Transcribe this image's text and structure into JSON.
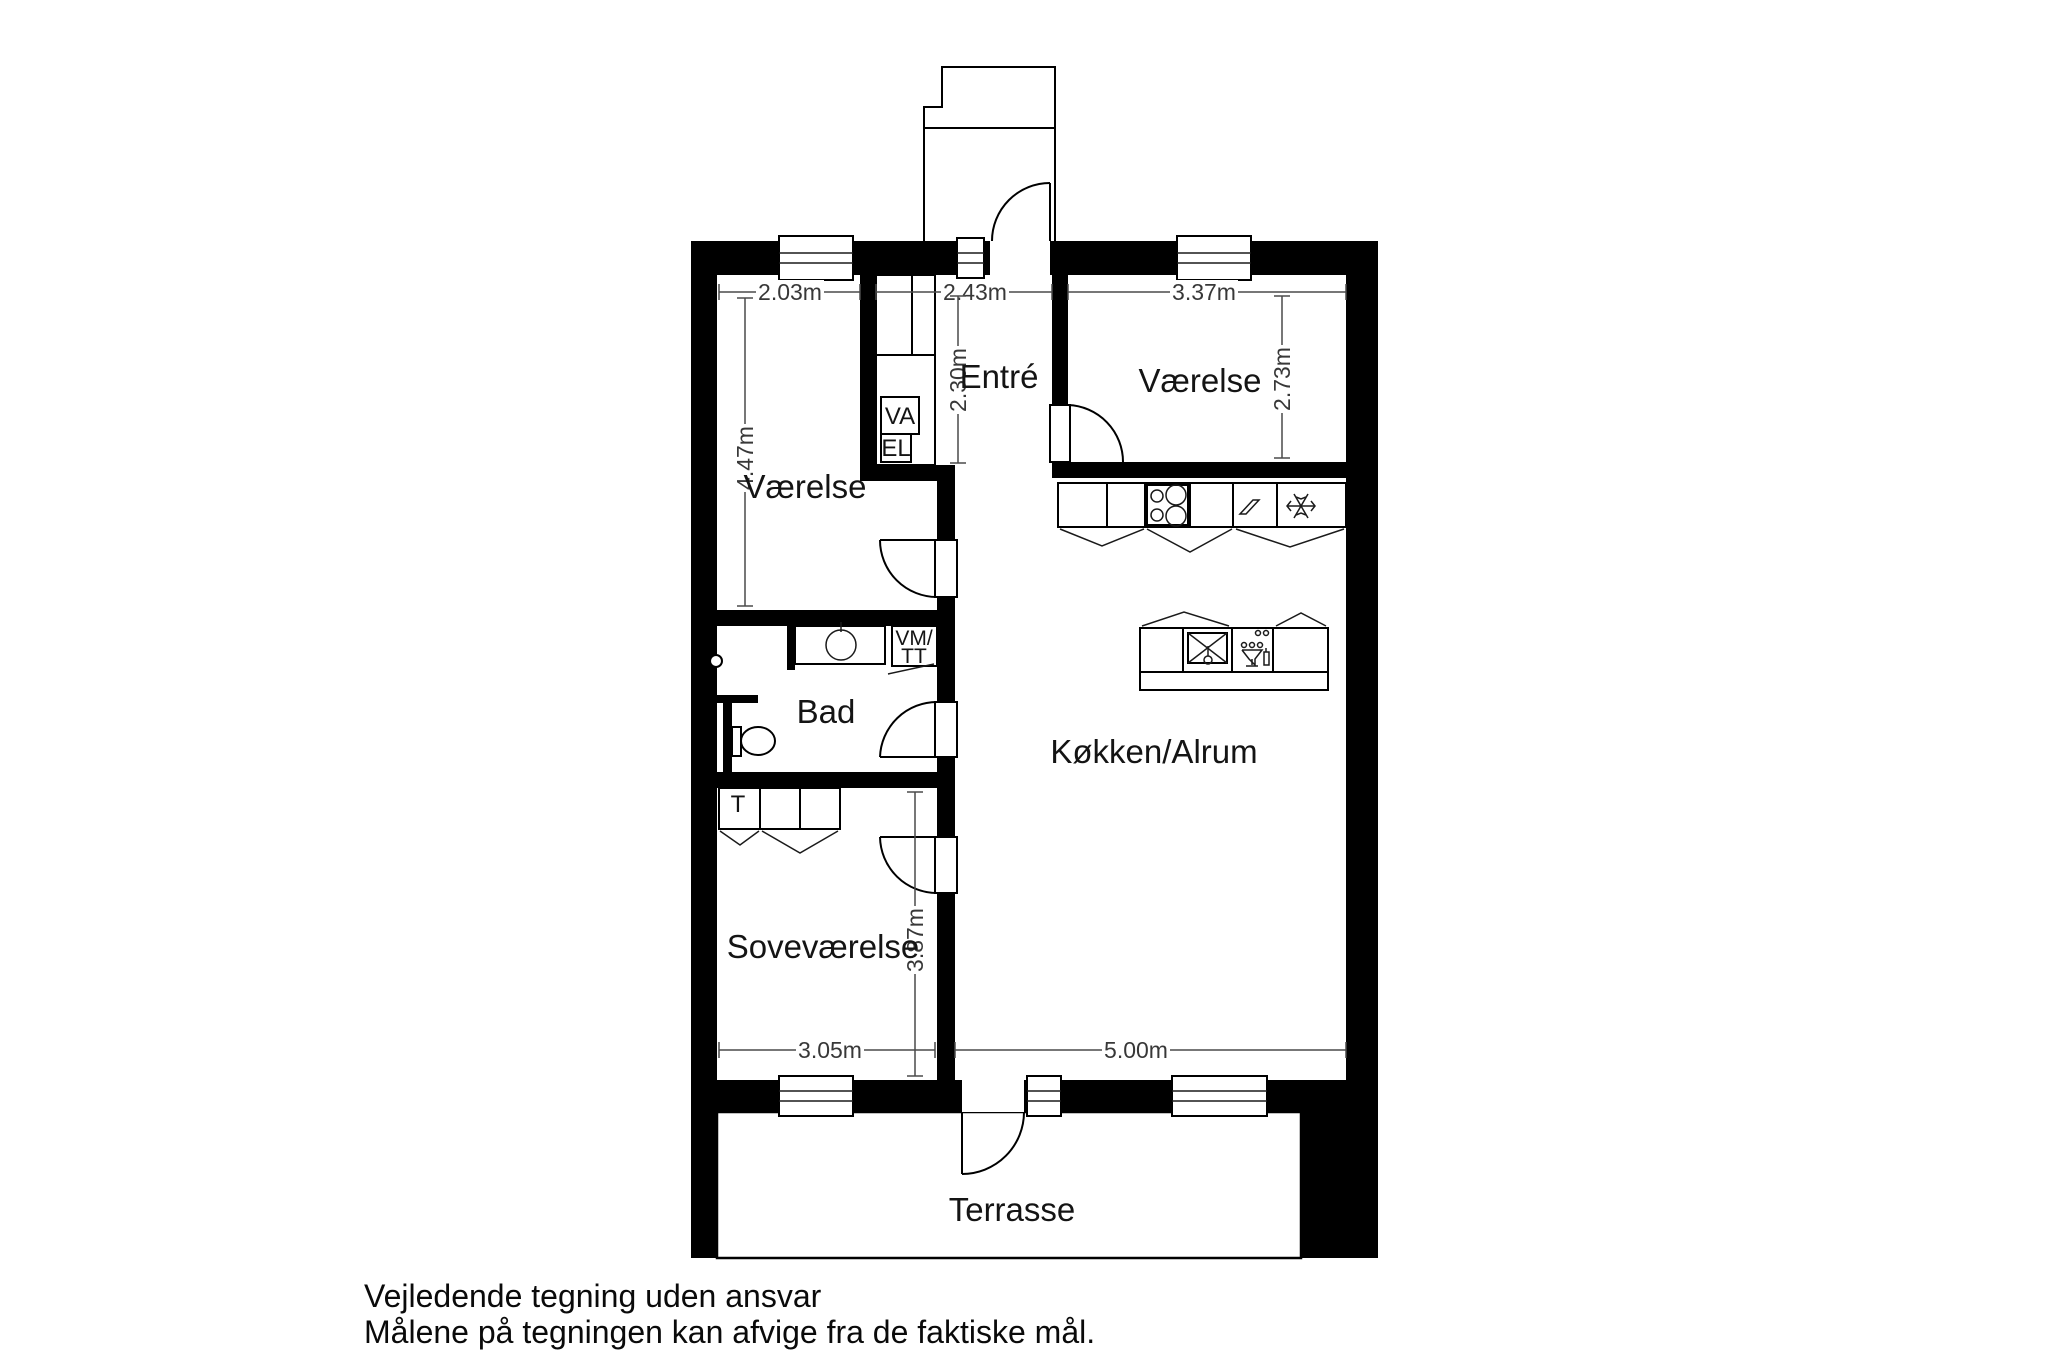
{
  "document": {
    "type": "floor-plan",
    "footer": {
      "line1": "Vejledende tegning uden ansvar",
      "line2": "Målene på tegningen kan afvige fra de faktiske mål."
    }
  },
  "rooms": {
    "vaerelse_left": {
      "label": "Værelse"
    },
    "vaerelse_right": {
      "label": "Værelse"
    },
    "entre": {
      "label": "Entré"
    },
    "bad": {
      "label": "Bad"
    },
    "sovevaerelse": {
      "label": "Soveværelse"
    },
    "kokken_alrum": {
      "label": "Køkken/Alrum"
    },
    "terrasse": {
      "label": "Terrasse"
    }
  },
  "closets": {
    "va": {
      "label": "VA"
    },
    "el": {
      "label": "EL"
    },
    "vm_tt": {
      "line1": "VM/",
      "line2": "TT"
    },
    "t": {
      "label": "T"
    }
  },
  "dimensions": {
    "vaerelse_left_width": {
      "label": "2.03m"
    },
    "entre_width": {
      "label": "2.43m"
    },
    "vaerelse_right_width": {
      "label": "3.37m"
    },
    "vaerelse_left_depth": {
      "label": "4.47m"
    },
    "entre_depth": {
      "label": "2.30m"
    },
    "vaerelse_right_depth": {
      "label": "2.73m"
    },
    "sovevaerelse_depth": {
      "label": "3.87m"
    },
    "sovevaerelse_width": {
      "label": "3.05m"
    },
    "kokken_width": {
      "label": "5.00m"
    }
  },
  "icons": {
    "stove": "four-burner-circles",
    "freezer": "snowflake",
    "appliance_power": "zigzag",
    "island_sink": "crossed-square-with-tap",
    "dishwasher": "wine-glass-with-dots",
    "toilet": "toilet-bowl",
    "washbasin": "circle-basin",
    "shower": "shower-head-circle"
  },
  "colors": {
    "wall": "#000000",
    "background": "#ffffff",
    "line": "#1a1a1a",
    "dim_text": "#383838"
  }
}
